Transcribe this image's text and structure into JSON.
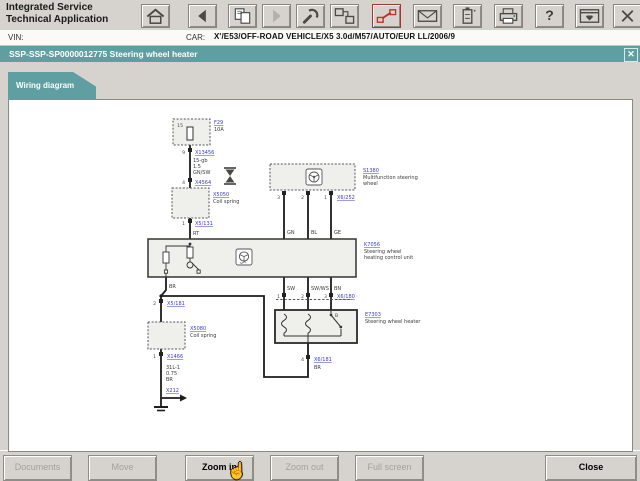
{
  "header": {
    "brand_line1": "Integrated Service",
    "brand_line2": "Technical Application",
    "toolbar": [
      {
        "icon": "home-icon"
      },
      {
        "icon": "back-icon"
      },
      {
        "icon": "documents-transfer-icon"
      },
      {
        "icon": "forward-icon"
      },
      {
        "icon": "wrench-icon"
      },
      {
        "icon": "measurement-device-icon"
      },
      {
        "icon": "vehicle-connection-icon"
      },
      {
        "icon": "mail-icon"
      },
      {
        "icon": "battery-icon"
      },
      {
        "icon": "printer-icon"
      },
      {
        "icon": "help-icon"
      },
      {
        "icon": "dock-window-icon"
      },
      {
        "icon": "close-icon"
      }
    ],
    "help_glyph": "?"
  },
  "vin_row": {
    "vin_label": "VIN:",
    "car_label": "CAR:",
    "car_value": "X'/E53/OFF-ROAD VEHICLE/X5 3.0d/M57/AUTO/EUR LL/2006/9"
  },
  "title_bar": {
    "text": "SSP-SSP-SP0000012775 Steering wheel heater",
    "close_glyph": "✕"
  },
  "tab": {
    "label": "Wiring diagram"
  },
  "diagram": {
    "fuse_terminal": "15",
    "fuse_id": "F29",
    "fuse_rating": "10A",
    "pin9": "9",
    "x13456": "X13456",
    "wire1_l1": "15-gb",
    "wire1_l2": "1.5",
    "wire1_l3": "GN/SW",
    "pin4": "4",
    "x4564": "X4564",
    "cs_upper_id": "X5050",
    "cs_upper_label": "Coil spring",
    "pin1_cs": "1",
    "x5131": "X5/131",
    "w_rt": "RT",
    "mfsw_id": "S1380",
    "mfsw_l1": "Multifunction steering",
    "mfsw_l2": "wheel",
    "pin3_m": "3",
    "pin2_m": "2",
    "pin1_m": "1",
    "x6252": "X6/252",
    "w_gn": "GN",
    "w_bl": "BL",
    "w_ge": "GE",
    "cu_id": "K7056",
    "cu_l1": "Steering wheel",
    "cu_l2": "heating control unit",
    "w_sw": "SW",
    "w_swws": "SW/WS",
    "w_bn": "BN",
    "pin1_h": "1",
    "pin2_h": "2",
    "pin3_h": "3",
    "x6180": "X6/180",
    "heater_id": "E7303",
    "heater_label": "Steering wheel heater",
    "switch_label": "B",
    "pin4_h": "4",
    "x6181": "X6/181",
    "w_br2": "BR",
    "w_br1": "BR",
    "pin2_g": "2",
    "x5181": "X5/181",
    "cs_lower_id": "X5080",
    "cs_lower_label": "Coil spring",
    "pin1_g": "1",
    "x1466": "X1466",
    "gnd_l1": "31L-1",
    "gnd_l2": "0.75",
    "gnd_l3": "BR",
    "x212": "X212"
  },
  "footer": {
    "buttons": [
      {
        "label": "Documents",
        "enabled": false
      },
      {
        "label": "Move",
        "enabled": false
      },
      {
        "label": "Zoom in",
        "enabled": true
      },
      {
        "label": "Zoom out",
        "enabled": false
      },
      {
        "label": "Full screen",
        "enabled": false
      },
      {
        "label": "Close",
        "enabled": true
      }
    ],
    "cursor_glyph": "☝"
  },
  "colors": {
    "teal": "#5f9fa1",
    "link_blue": "#3a3acc",
    "alert_red": "#c03028"
  }
}
